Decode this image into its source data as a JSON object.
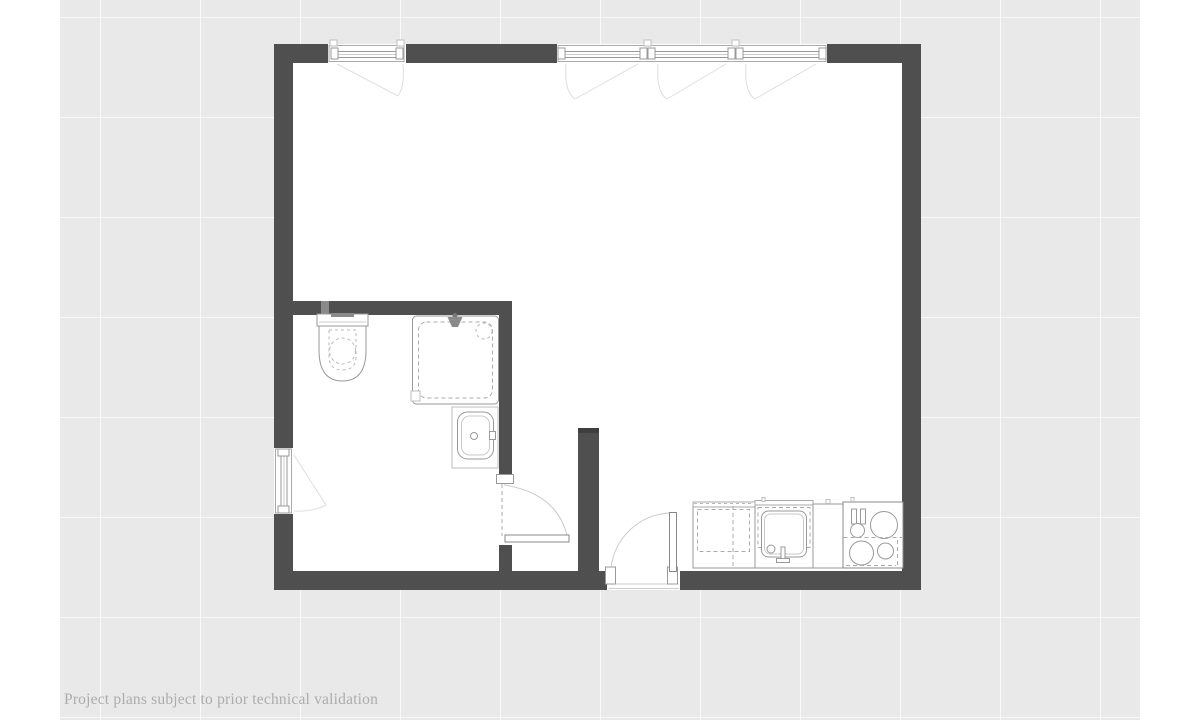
{
  "screen": {
    "width": 1200,
    "height": 720
  },
  "disclaimer": {
    "text": "Project plans subject to prior technical validation"
  },
  "palette": {
    "margin": "#ffffff",
    "background": "#e9e9e9",
    "grid_line": "#f5f5f5",
    "wall": "#4f4f4f",
    "wall_cap": "#3e3e3e",
    "floor": "#ffffff",
    "fixture_line": "#999999",
    "faint_line": "#dedede",
    "disclaimer_text": "#acacac"
  },
  "floorplan": {
    "rooms": [
      "main-room",
      "bathroom",
      "entry-vestibule"
    ],
    "openings": [
      "top-left-casement-window",
      "top-right-triple-casement-window",
      "left-casement-window",
      "entry-door",
      "bathroom-door"
    ],
    "fixtures": [
      "toilet",
      "shower",
      "washbasin",
      "kitchen-cabinet",
      "kitchen-sink",
      "kitchen-counter",
      "cooktop"
    ]
  }
}
